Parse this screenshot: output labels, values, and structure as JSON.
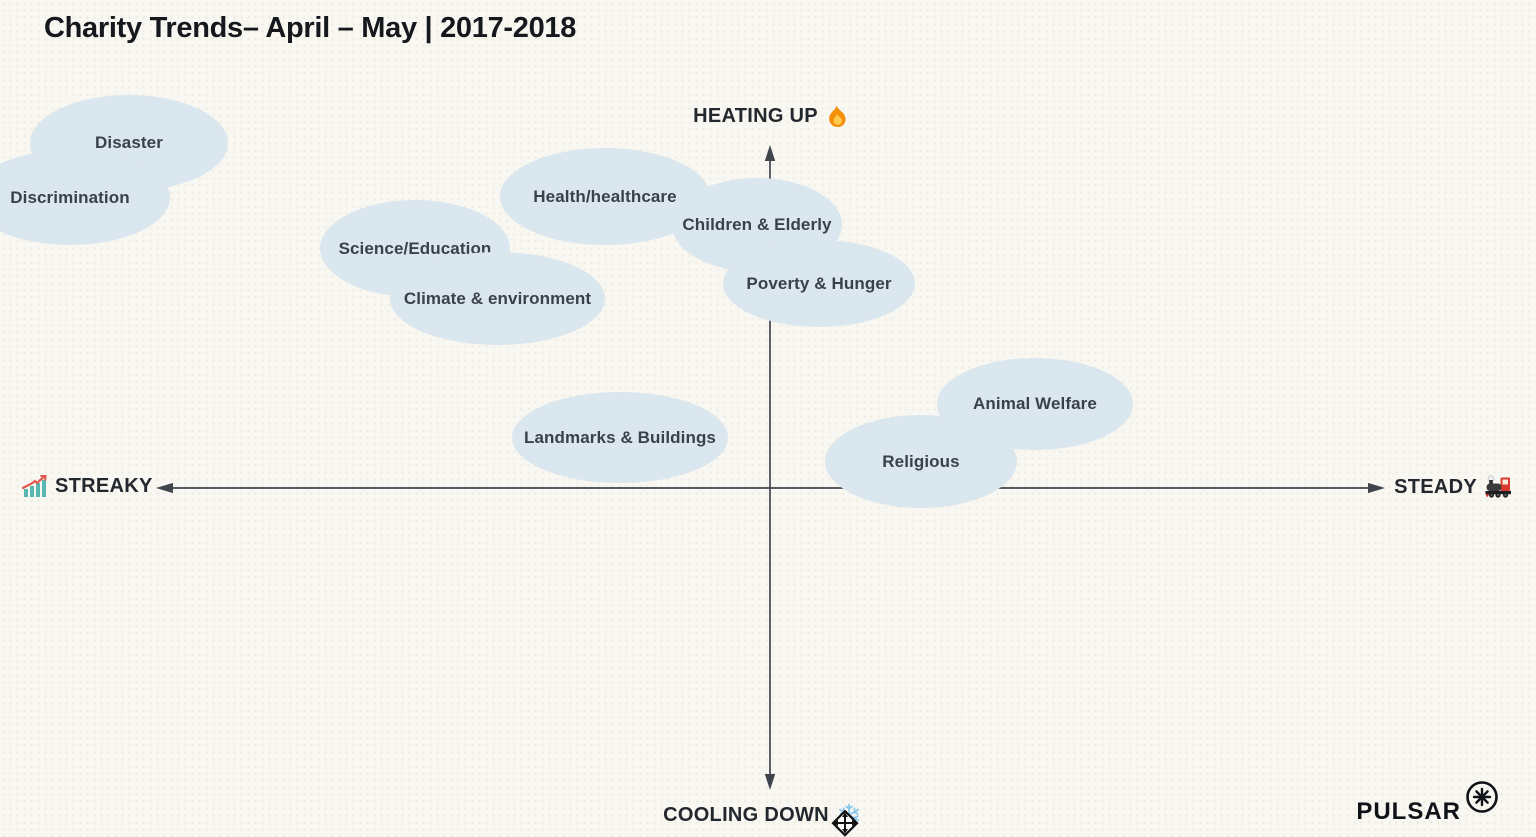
{
  "title": "Charity Trends– April – May | 2017-2018",
  "axes": {
    "top": {
      "label": "HEATING UP",
      "icon": "fire-icon"
    },
    "bottom": {
      "label": "COOLING DOWN",
      "icon": "snowflake-icon"
    },
    "left": {
      "label": "STREAKY",
      "icon": "chart-increasing-icon"
    },
    "right": {
      "label": "STEADY",
      "icon": "locomotive-icon"
    }
  },
  "branding": {
    "logo_text": "PULSAR",
    "logo_mark": "starburst-circle-icon"
  },
  "icons": {
    "cursor": "move-cursor-icon"
  },
  "colors": {
    "background": "#f8f7f1",
    "bubble_fill": "#dbe7ee",
    "bubble_text": "#3b414b",
    "axis": "#40454d",
    "title": "#15181d"
  },
  "bubbles": [
    {
      "label": "Disaster",
      "left": 30,
      "top": 95,
      "width": 198,
      "height": 96
    },
    {
      "label": "Discrimination",
      "left": -30,
      "top": 150,
      "width": 200,
      "height": 95
    },
    {
      "label": "Health/healthcare",
      "left": 500,
      "top": 148,
      "width": 210,
      "height": 97
    },
    {
      "label": "Children & Elderly",
      "left": 672,
      "top": 178,
      "width": 170,
      "height": 94
    },
    {
      "label": "Science/Education",
      "left": 320,
      "top": 200,
      "width": 190,
      "height": 97
    },
    {
      "label": "Poverty & Hunger",
      "left": 723,
      "top": 240,
      "width": 192,
      "height": 87
    },
    {
      "label": "Climate & environment",
      "left": 390,
      "top": 252,
      "width": 215,
      "height": 93
    },
    {
      "label": "Animal Welfare",
      "left": 937,
      "top": 358,
      "width": 196,
      "height": 92
    },
    {
      "label": "Landmarks & Buildings",
      "left": 512,
      "top": 392,
      "width": 216,
      "height": 91
    },
    {
      "label": "Religious",
      "left": 825,
      "top": 415,
      "width": 192,
      "height": 93
    }
  ],
  "chart_data": {
    "type": "scatter",
    "title": "Charity Trends– April – May | 2017-2018",
    "x_axis": {
      "negative_label": "STREAKY",
      "positive_label": "STEADY",
      "range": [
        -1,
        1
      ]
    },
    "y_axis": {
      "negative_label": "COOLING DOWN",
      "positive_label": "HEATING UP",
      "range": [
        -1,
        1
      ]
    },
    "grid": false,
    "legend": false,
    "points": [
      {
        "label": "Disaster",
        "x": -1.04,
        "y": 1.01
      },
      {
        "label": "Discrimination",
        "x": -1.14,
        "y": 0.86
      },
      {
        "label": "Health/healthcare",
        "x": -0.27,
        "y": 0.86
      },
      {
        "label": "Children & Elderly",
        "x": -0.02,
        "y": 0.77
      },
      {
        "label": "Science/Education",
        "x": -0.58,
        "y": 0.71
      },
      {
        "label": "Poverty & Hunger",
        "x": 0.08,
        "y": 0.6
      },
      {
        "label": "Climate & environment",
        "x": -0.44,
        "y": 0.56
      },
      {
        "label": "Animal Welfare",
        "x": 0.43,
        "y": 0.25
      },
      {
        "label": "Landmarks & Buildings",
        "x": -0.24,
        "y": 0.15
      },
      {
        "label": "Religious",
        "x": 0.25,
        "y": 0.08
      }
    ]
  }
}
